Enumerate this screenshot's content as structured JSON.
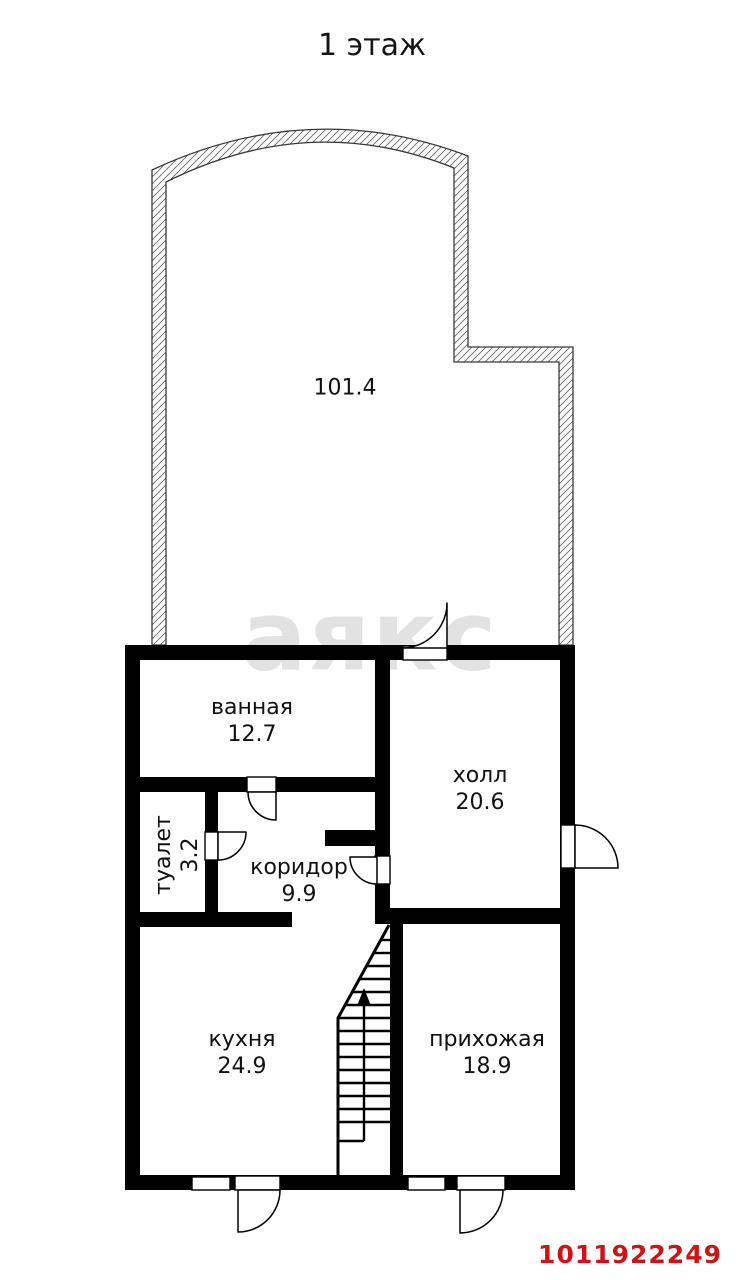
{
  "page": {
    "title": "1 этаж",
    "watermark": "аякс",
    "listing_id": "1011922249"
  },
  "rooms": {
    "main": {
      "name": "",
      "area": "101.4"
    },
    "bathroom": {
      "name": "ванная",
      "area": "12.7"
    },
    "toilet": {
      "name": "туалет",
      "area": "3.2"
    },
    "corridor": {
      "name": "коридор",
      "area": "9.9"
    },
    "hall": {
      "name": "холл",
      "area": "20.6"
    },
    "kitchen": {
      "name": "кухня",
      "area": "24.9"
    },
    "entryway": {
      "name": "прихожая",
      "area": "18.9"
    }
  },
  "colors": {
    "wall": "#000000",
    "watermark": "#e2e2e2",
    "listing_id": "#cd1414"
  }
}
